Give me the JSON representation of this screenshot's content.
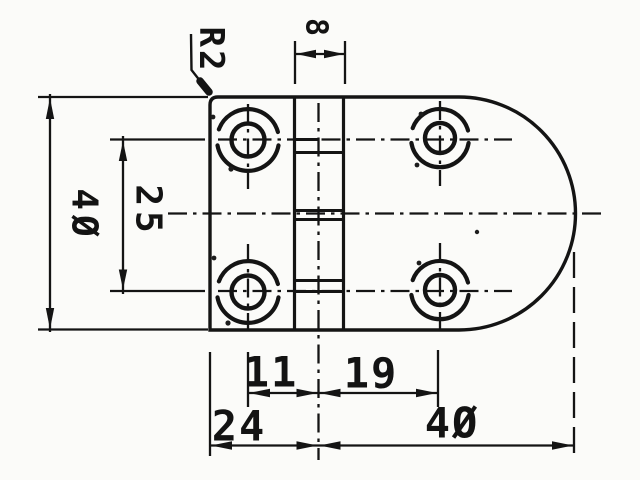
{
  "drawing": {
    "part_name": "hinge-plate technical drawing",
    "paper_color": "#fbfbf9",
    "ink_color": "#141414",
    "dimension_labels": {
      "corner_radius": "R2",
      "pin_width": "8",
      "overall_height": "4Ø",
      "hole_row_pitch": "25",
      "pin_to_left_hole_column": "11",
      "pin_to_right_hole_column": "19",
      "left_edge_to_pin_axis": "24",
      "pin_axis_to_right_edge": "4Ø"
    }
  }
}
